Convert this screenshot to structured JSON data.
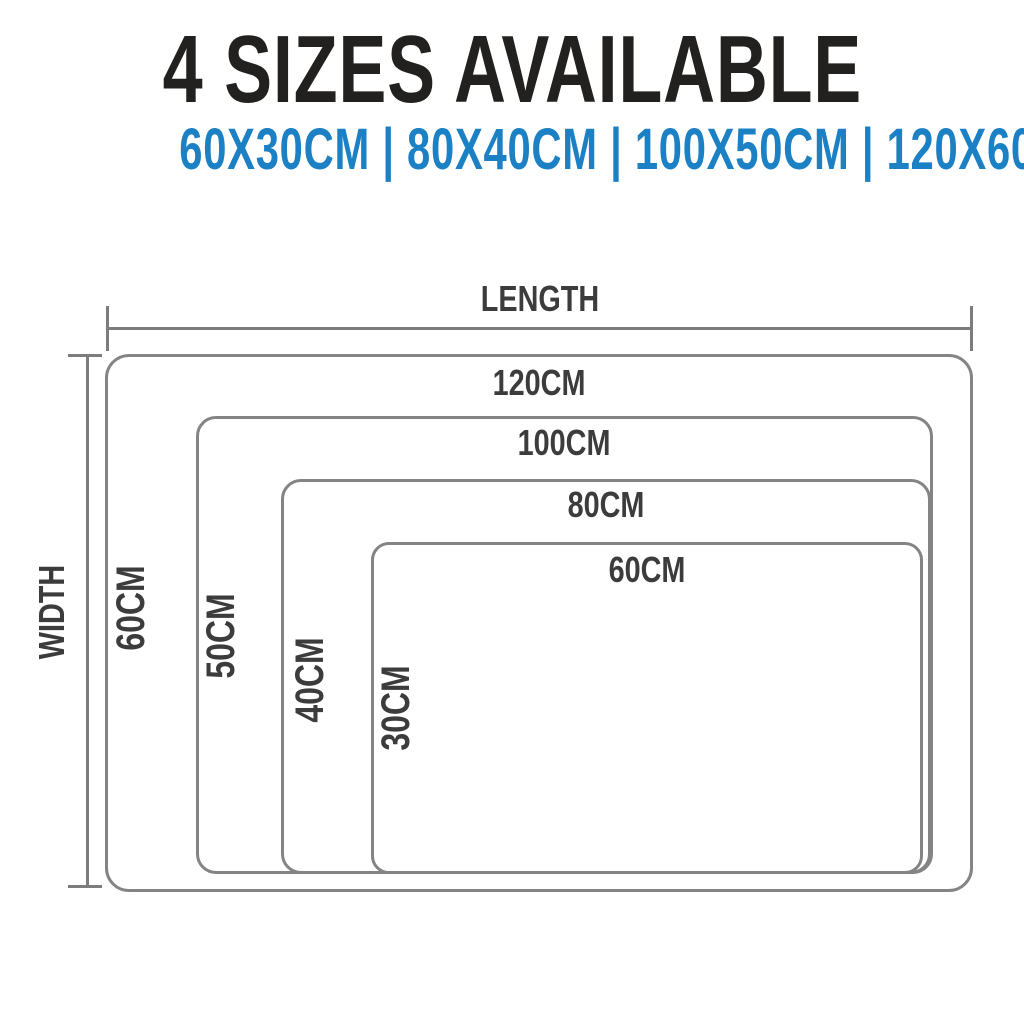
{
  "colors": {
    "background": "#ffffff",
    "title_black": "#232120",
    "accent_blue": "#1b80c4",
    "diagram_text_gray": "#3c3c3c",
    "line_gray": "#7c7c7c",
    "rect_border_gray": "#848484"
  },
  "header": {
    "title": "4 SIZES AVAILABLE",
    "sizes_display": "60X30CM | 80X40CM | 100X50CM | 120X60CM",
    "sizes": [
      "60X30CM",
      "80X40CM",
      "100X50CM",
      "120X60CM"
    ]
  },
  "diagram": {
    "length_axis_label": "LENGTH",
    "width_axis_label": "WIDTH",
    "rects": [
      {
        "size": "120X60CM",
        "length_label": "120CM",
        "width_label": "60CM"
      },
      {
        "size": "100X50CM",
        "length_label": "100CM",
        "width_label": "50CM"
      },
      {
        "size": "80X40CM",
        "length_label": "80CM",
        "width_label": "40CM"
      },
      {
        "size": "60X30CM",
        "length_label": "60CM",
        "width_label": "30CM"
      }
    ]
  }
}
